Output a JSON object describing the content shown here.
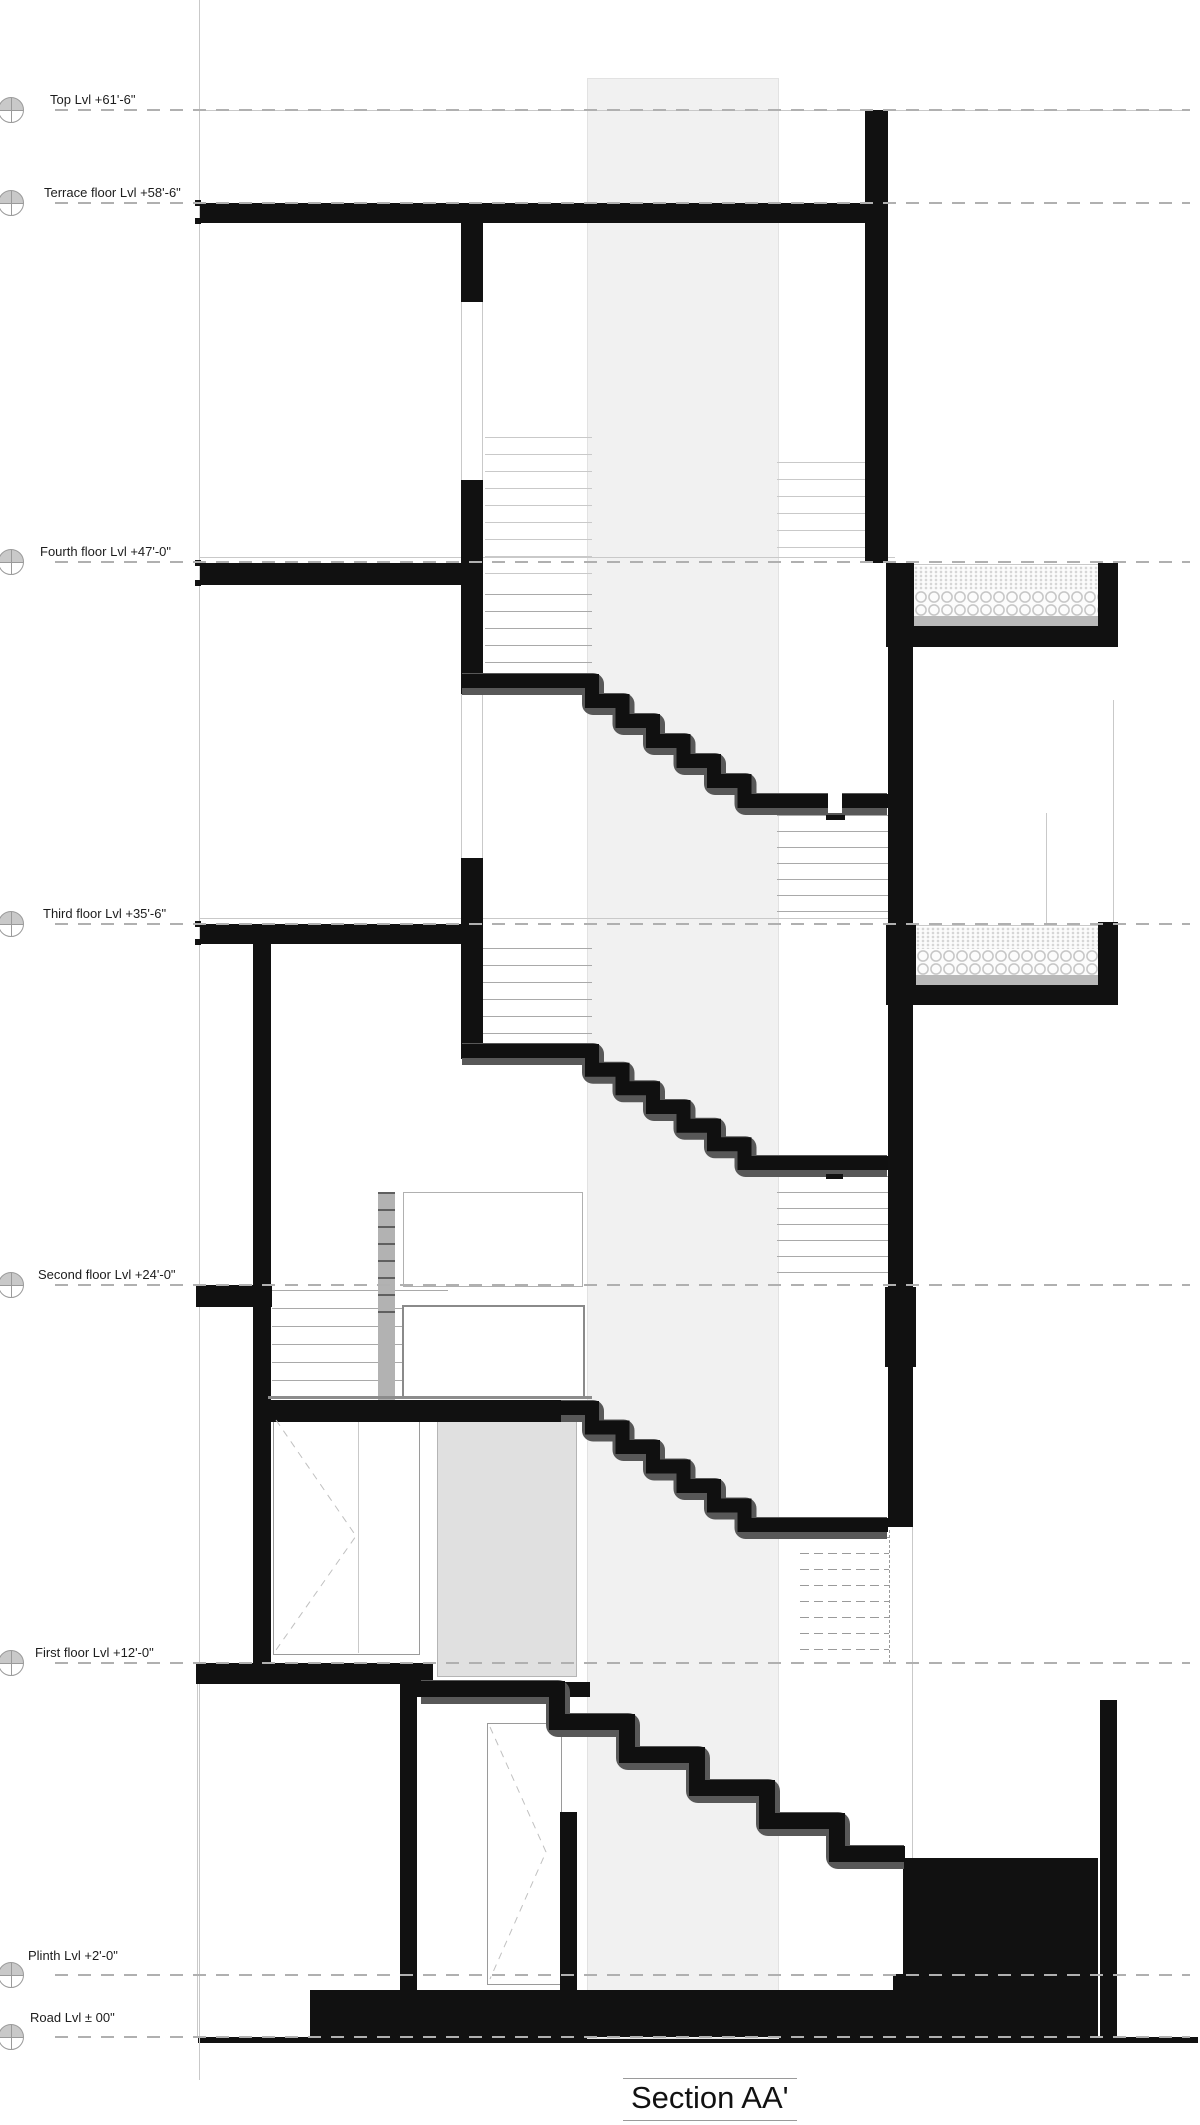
{
  "drawing": {
    "title": "Section AA'",
    "levels": [
      {
        "label": "Top Lvl +61'-6\""
      },
      {
        "label": "Terrace floor Lvl +58'-6\""
      },
      {
        "label": "Fourth floor Lvl +47'-0\""
      },
      {
        "label": "Third floor Lvl +35'-6\""
      },
      {
        "label": "Second floor Lvl +24'-0\""
      },
      {
        "label": "First floor Lvl +12'-0\""
      },
      {
        "label": "Plinth Lvl +2'-0\""
      },
      {
        "label": "Road Lvl ± 00\""
      }
    ],
    "colors": {
      "ink": "#111111",
      "stair_halo": "#585858",
      "shaft_band": "#f1f1f1",
      "level_dash": "#b0b0b0",
      "marker_fill": "#c9c9c9"
    }
  }
}
